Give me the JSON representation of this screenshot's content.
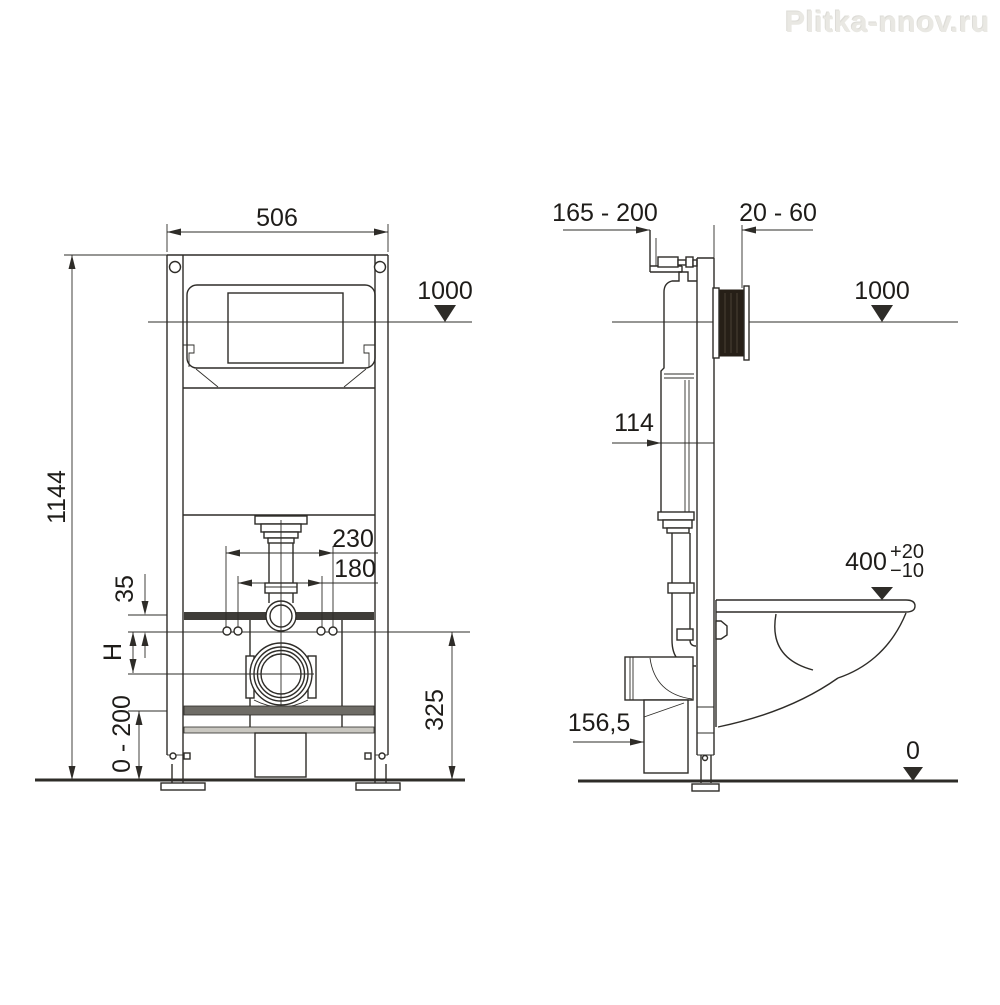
{
  "watermark": "Plitka-nnov.ru",
  "front_view": {
    "frame_width": "506",
    "frame_height": "1144",
    "level_height": "1000",
    "outer_bolt_spacing": "230",
    "inner_bolt_spacing": "180",
    "rail_offset": "35",
    "drain_height_label": "H",
    "drain_ref_height": "325",
    "leg_adjust_range": "0 - 200"
  },
  "side_view": {
    "frame_depth_range": "165 - 200",
    "wall_finish_range": "20 - 60",
    "level_height": "1000",
    "tank_depth": "114",
    "seat_height": "400",
    "seat_height_plus_tol": "+20",
    "seat_height_minus_tol": "−10",
    "drain_center_depth": "156,5",
    "floor_level": "0"
  }
}
